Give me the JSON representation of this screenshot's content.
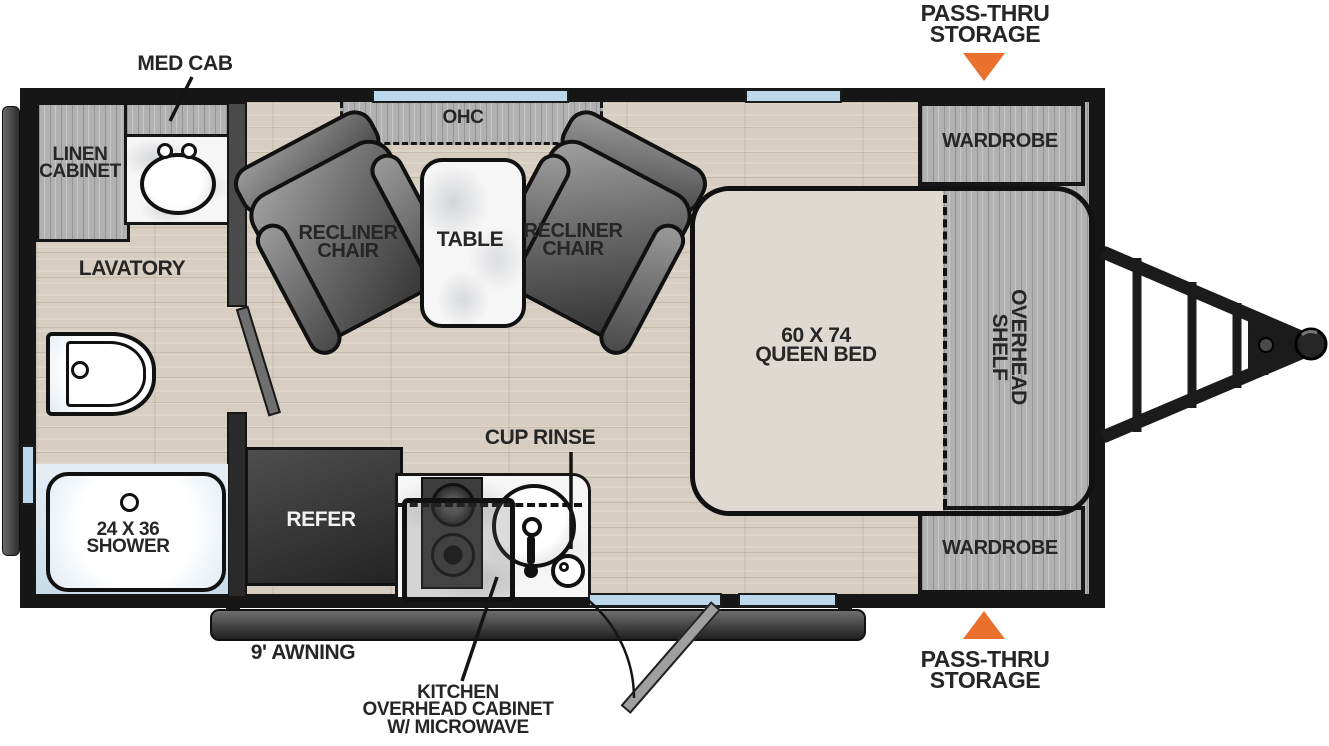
{
  "diagram": {
    "title": "travel-trailer-floorplan",
    "colors": {
      "accent_orange": "#ea712d",
      "window_blue": "#bcd8ec",
      "wall_black": "#161616",
      "floor_wood": "#d7cec1",
      "cabinet_gray": "#b1b1b1",
      "bed_beige": "#dedad2"
    },
    "callouts": {
      "pass_thru_top": [
        "PASS-THRU",
        "STORAGE"
      ],
      "pass_thru_bottom": [
        "PASS-THRU",
        "STORAGE"
      ],
      "med_cab": "MED CAB",
      "cup_rinse": "CUP RINSE",
      "awning": "9' AWNING",
      "kitchen_ohc": [
        "KITCHEN",
        "OVERHEAD CABINET",
        "W/ MICROWAVE"
      ]
    },
    "areas": {
      "linen_cabinet": [
        "LINEN",
        "CABINET"
      ],
      "lavatory": "LAVATORY",
      "shower": [
        "24 X 36",
        "SHOWER"
      ],
      "ohc": "OHC",
      "recliner_left": [
        "RECLINER",
        "CHAIR"
      ],
      "recliner_right": [
        "RECLINER",
        "CHAIR"
      ],
      "table": "TABLE",
      "refer": "REFER",
      "queen_bed": [
        "60 X 74",
        "QUEEN BED"
      ],
      "overhead_shelf": [
        "OVERHEAD",
        "SHELF"
      ],
      "wardrobe_top": "WARDROBE",
      "wardrobe_bottom": "WARDROBE"
    }
  }
}
